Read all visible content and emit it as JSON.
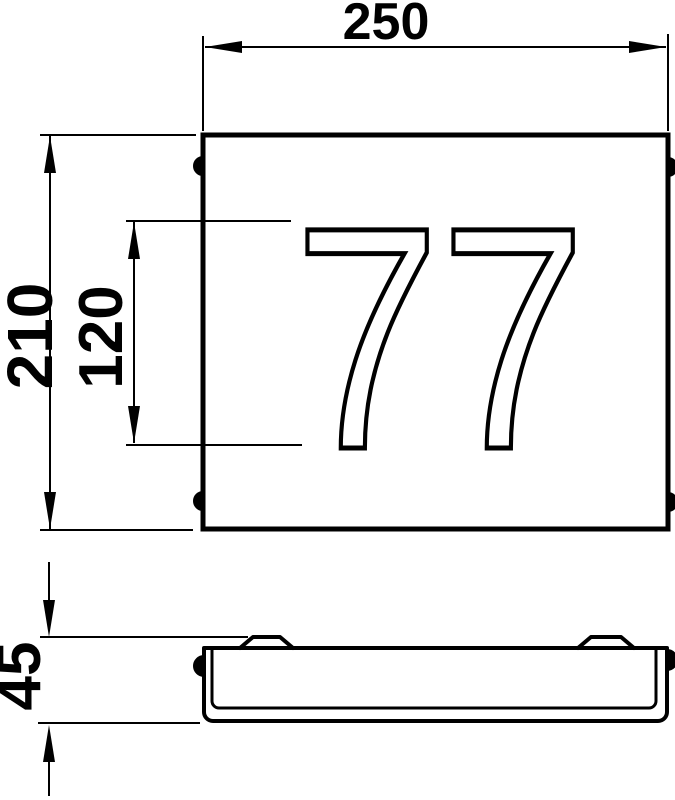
{
  "drawing": {
    "house_number": "77",
    "dimensions": {
      "overall_width": "250",
      "overall_height": "210",
      "digit_height": "120",
      "overall_depth": "45"
    },
    "colors": {
      "line": "#000000",
      "background": "#ffffff"
    }
  }
}
